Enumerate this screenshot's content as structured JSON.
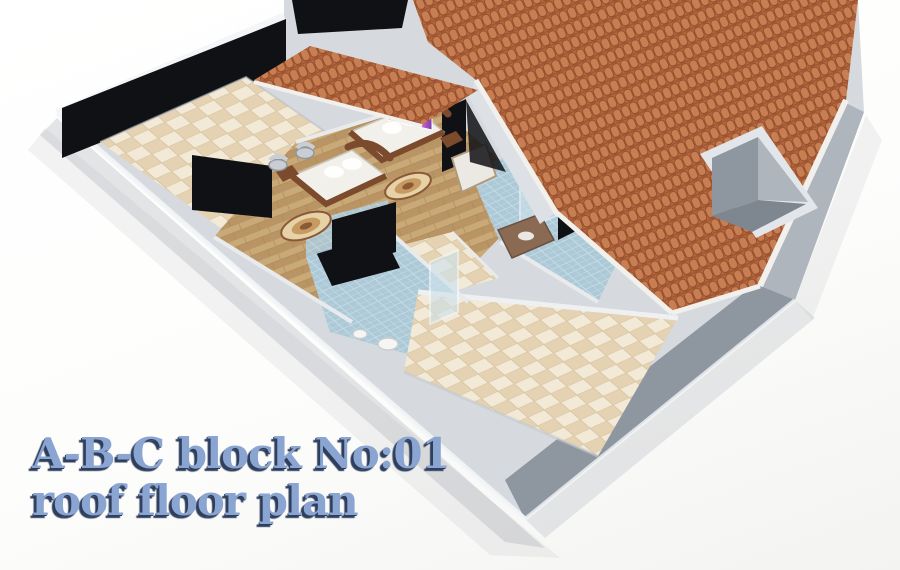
{
  "title": {
    "line1": "A-B-C block No:01",
    "line2": "roof floor plan"
  },
  "colors": {
    "title_text": "#8aa5d2",
    "title_shadow": "#2e3e5c",
    "roof": "#b4663e",
    "roof_tile": "#c67e52",
    "roof_dark": "#8e4828",
    "roof_fascia": "#f2f0ec",
    "wall_light": "#d6dade",
    "wall_mid": "#aeb5bd",
    "wall_dark": "#8e96a0",
    "wall_top": "#f3f5f7",
    "glass_black": "#101114",
    "tile_cream_a": "#f2e9d6",
    "tile_cream_b": "#e4d2b2",
    "tile_grout": "#d8c6a4",
    "tile_blue_a": "#adc9d7",
    "tile_blue_b": "#c3dbe5",
    "wood_a": "#c9a978",
    "wood_b": "#b99565",
    "wood_line": "#a8854f",
    "bed_frame": "#7c4a2d",
    "bedding": "#f2f0ea",
    "rug_dark": "#8a5a36",
    "rug_mid": "#c79a62",
    "rug_light": "#e7d2a8",
    "chrome": "#c9ced5",
    "vanity": "#8a6a52",
    "fixture_white": "#f5f6f4",
    "shadow": "#9aa0a8"
  }
}
